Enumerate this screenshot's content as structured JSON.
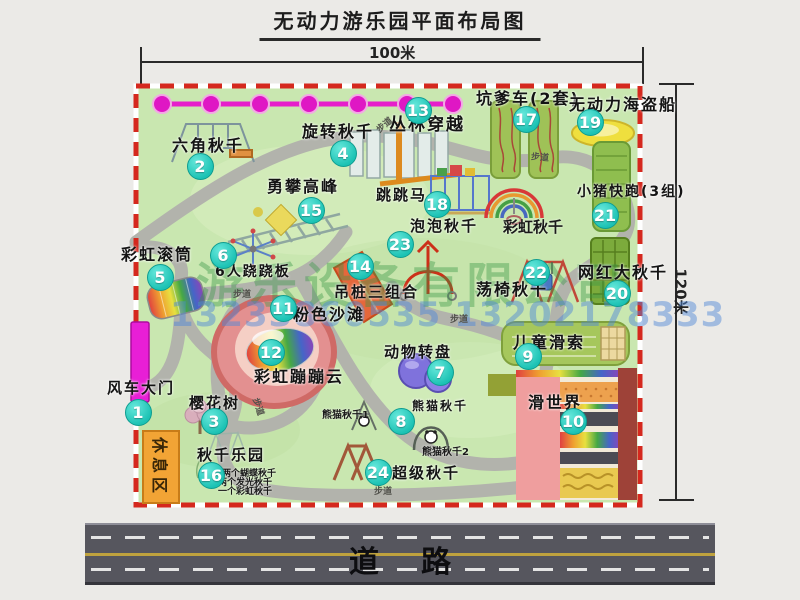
{
  "title": "无动力游乐园平面布局图",
  "dimensions": {
    "width": "100米",
    "height": "120米"
  },
  "road_label": "道路",
  "watermark": {
    "company": "游乐设备有限公司",
    "phone": "13233860535 13202178333"
  },
  "rest_area_label": "休息区",
  "walkway": {
    "label": "步道",
    "positions": [
      {
        "x": 375,
        "y": 118,
        "r": -40
      },
      {
        "x": 531,
        "y": 150,
        "r": 5
      },
      {
        "x": 233,
        "y": 287,
        "r": 0
      },
      {
        "x": 450,
        "y": 312,
        "r": 0
      },
      {
        "x": 374,
        "y": 484,
        "r": 0
      },
      {
        "x": 250,
        "y": 400,
        "r": 72
      }
    ]
  },
  "attractions": [
    {
      "num": "1",
      "label": "风车大门",
      "cx": 138,
      "cy": 412,
      "lx": 107,
      "ly": 380,
      "fs": 15
    },
    {
      "num": "2",
      "label": "六角秋千",
      "cx": 200,
      "cy": 166,
      "lx": 172,
      "ly": 137,
      "fs": 16
    },
    {
      "num": "3",
      "label": "樱花树",
      "cx": 214,
      "cy": 421,
      "lx": 189,
      "ly": 395,
      "fs": 15
    },
    {
      "num": "4",
      "label": "旋转秋千",
      "cx": 343,
      "cy": 153,
      "lx": 302,
      "ly": 123,
      "fs": 16
    },
    {
      "num": "5",
      "label": "彩虹滚筒",
      "cx": 160,
      "cy": 277,
      "lx": 121,
      "ly": 246,
      "fs": 16
    },
    {
      "num": "6",
      "label": "6人跷跷板",
      "cx": 223,
      "cy": 255,
      "lx": 215,
      "ly": 265,
      "fs": 14
    },
    {
      "num": "7",
      "label": "动物转盘",
      "cx": 440,
      "cy": 372,
      "lx": 384,
      "ly": 344,
      "fs": 15
    },
    {
      "num": "8",
      "label": "熊猫秋千",
      "cx": 401,
      "cy": 421,
      "lx": 412,
      "ly": 400,
      "fs": 12
    },
    {
      "num": "9",
      "label": "儿童滑索",
      "cx": 528,
      "cy": 356,
      "lx": 513,
      "ly": 334,
      "fs": 16
    },
    {
      "num": "10",
      "label": "滑世界",
      "cx": 573,
      "cy": 421,
      "lx": 528,
      "ly": 394,
      "fs": 16
    },
    {
      "num": "11",
      "label": "粉色沙滩",
      "cx": 283,
      "cy": 308,
      "lx": 293,
      "ly": 306,
      "fs": 16
    },
    {
      "num": "12",
      "label": "彩虹蹦蹦云",
      "cx": 271,
      "cy": 352,
      "lx": 254,
      "ly": 368,
      "fs": 16
    },
    {
      "num": "13",
      "label": "丛林穿越",
      "cx": 418,
      "cy": 110,
      "lx": 389,
      "ly": 116,
      "fs": 17
    },
    {
      "num": "14",
      "label": "吊桩三组合",
      "cx": 360,
      "cy": 266,
      "lx": 334,
      "ly": 284,
      "fs": 15
    },
    {
      "num": "15",
      "label": "勇攀高峰",
      "cx": 311,
      "cy": 210,
      "lx": 267,
      "ly": 178,
      "fs": 16
    },
    {
      "num": "16",
      "label": "秋千乐园",
      "cx": 211,
      "cy": 475,
      "lx": 197,
      "ly": 447,
      "fs": 15
    },
    {
      "num": "17",
      "label": "坑爹车(2套)",
      "cx": 526,
      "cy": 119,
      "lx": 476,
      "ly": 90,
      "fs": 16
    },
    {
      "num": "18",
      "label": "跳跳马",
      "cx": 437,
      "cy": 204,
      "lx": 376,
      "ly": 187,
      "fs": 15
    },
    {
      "num": "19",
      "label": "无动力海盗船",
      "cx": 590,
      "cy": 122,
      "lx": 569,
      "ly": 96,
      "fs": 16
    },
    {
      "num": "20",
      "label": "网红大秋千",
      "cx": 617,
      "cy": 293,
      "lx": 578,
      "ly": 264,
      "fs": 16
    },
    {
      "num": "21",
      "label": "小猪快跑(3组)",
      "cx": 605,
      "cy": 215,
      "lx": 577,
      "ly": 185,
      "fs": 14
    },
    {
      "num": "22",
      "label": "荡椅秋千",
      "cx": 536,
      "cy": 272,
      "lx": 476,
      "ly": 281,
      "fs": 16
    },
    {
      "num": "23",
      "label": "泡泡秋千",
      "cx": 400,
      "cy": 244,
      "lx": 410,
      "ly": 218,
      "fs": 15
    },
    {
      "num": "24",
      "label": "超级秋千",
      "cx": 378,
      "cy": 472,
      "lx": 392,
      "ly": 465,
      "fs": 15
    }
  ],
  "annotations": [
    {
      "text": "彩虹秋千",
      "x": 503,
      "y": 216,
      "fs": 15
    },
    {
      "text": "熊猫秋千1",
      "x": 322,
      "y": 406,
      "fs": 10
    },
    {
      "text": "熊猫秋千2",
      "x": 422,
      "y": 443,
      "fs": 10
    },
    {
      "text": "两个蝴蝶秋千",
      "x": 222,
      "y": 466,
      "fs": 9
    },
    {
      "text": "两个发光秋千",
      "x": 218,
      "y": 475,
      "fs": 9
    },
    {
      "text": "一个彩虹秋千",
      "x": 218,
      "y": 484,
      "fs": 9
    }
  ]
}
